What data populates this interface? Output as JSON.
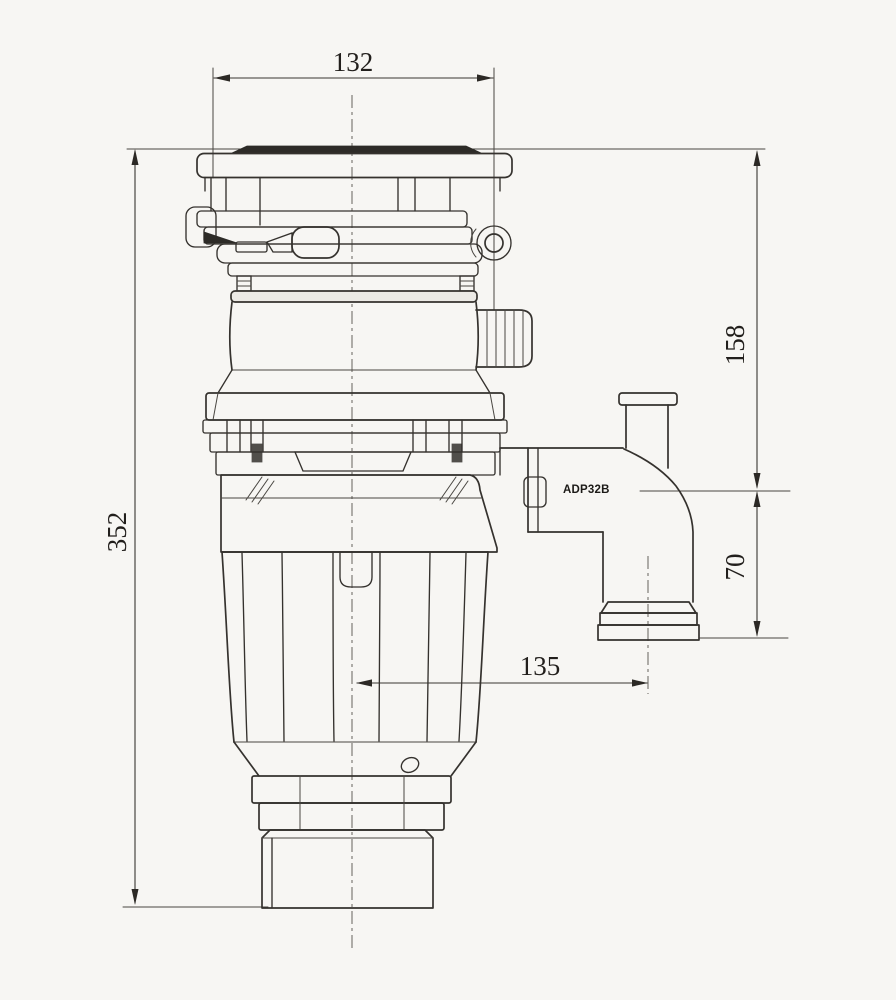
{
  "dimensions": {
    "top_width": "132",
    "overall_height": "352",
    "upper_height": "158",
    "outlet_drop": "70",
    "outlet_offset": "135"
  },
  "labels": {
    "adapter_model": "ADP32B"
  },
  "colors": {
    "line": "#35322e",
    "dark_fill": "#2d2b27",
    "background": "#f7f6f3"
  }
}
